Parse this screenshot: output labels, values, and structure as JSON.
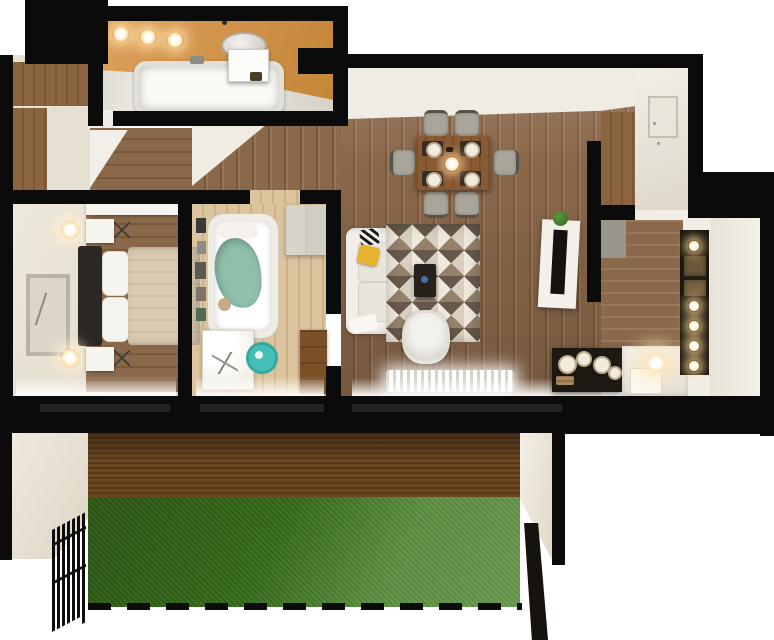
{
  "scene": {
    "type": "3d-floor-plan-render",
    "description": "Top-down 3D architectural render of a two-bedroom apartment with bathroom, hallway, living-dining room, kitchen and a back garden with lawn, deck and fences",
    "background": "#ffffff"
  },
  "palette": {
    "wall": "#0b0b0b",
    "floor_white": "#f1eee8",
    "cream": "#e6e0d3",
    "bath_orange": "#dda05c",
    "bath_orange_dark": "#c48637",
    "wood_mid": "#8a684a",
    "wood_dark": "#7a583b",
    "wood_light": "#97775a",
    "wood_pale": "#dcc49e",
    "wood_pale_dark": "#cdb288",
    "wardrobe_brown": "#8a6540",
    "deck": "#6b4722",
    "deck_dark": "#583818",
    "grass": "#3e7c1d",
    "teal": "#8fc0ac",
    "teal_chair": "#45c0b8",
    "duvet": "#d9cab1",
    "yellow": "#e6b32e",
    "dark_furn": "#1d1812",
    "chair_gray": "#a9a59a",
    "rug1": "#d8cfc0",
    "rug2": "#93816a",
    "rug3": "#efe9dd",
    "rug4": "#66584a",
    "glow": "#ffe3ae"
  },
  "rooms": [
    {
      "id": "bathroom",
      "name": "bathroom",
      "furniture": [
        "bathtub",
        "vanity-sink",
        "mirror",
        "ceiling-spotlights"
      ]
    },
    {
      "id": "entry-closet",
      "name": "entry closet",
      "furniture": [
        "wardrobe"
      ]
    },
    {
      "id": "hallway",
      "name": "hallway",
      "furniture": []
    },
    {
      "id": "master-bedroom",
      "name": "master bedroom",
      "furniture": [
        "double-bed",
        "nightstand",
        "lamp",
        "wall-art",
        "stool"
      ]
    },
    {
      "id": "kids-room",
      "name": "kids room",
      "furniture": [
        "crib",
        "desk",
        "desk-chair",
        "wardrobe",
        "dresser",
        "picture-frames"
      ]
    },
    {
      "id": "living-dining",
      "name": "living / dining room",
      "furniture": [
        "dining-table",
        "dining-chairs",
        "sofa",
        "rug",
        "coffee-table",
        "armchair",
        "tv-console",
        "tv",
        "plant",
        "radiator",
        "sideboard",
        "bench",
        "sphere-lamp"
      ]
    },
    {
      "id": "kitchen",
      "name": "kitchen",
      "furniture": [
        "tall-cabinet",
        "counter",
        "shelf-niche"
      ]
    },
    {
      "id": "garden",
      "name": "garden",
      "furniture": [
        "wood-deck",
        "lawn",
        "metal-fence",
        "fence-panel",
        "boundary-dashes"
      ]
    }
  ]
}
